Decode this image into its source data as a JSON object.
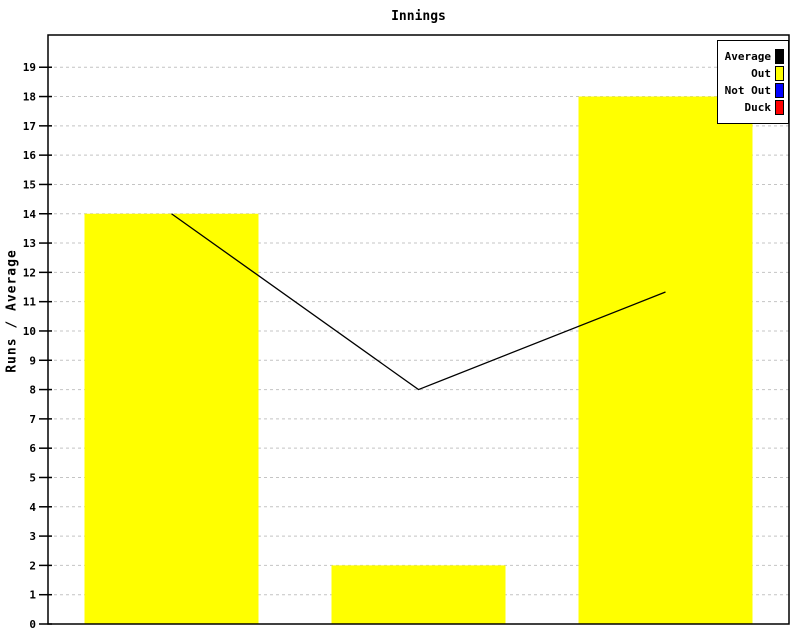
{
  "chart_data": {
    "type": "bar",
    "title": "Innings",
    "ylabel": "Runs / Average",
    "xlabel": "",
    "ylim": [
      0,
      20.1
    ],
    "yticks": [
      0,
      1,
      2,
      3,
      4,
      5,
      6,
      7,
      8,
      9,
      10,
      11,
      12,
      13,
      14,
      15,
      16,
      17,
      18,
      19
    ],
    "xticklabels_visible": false,
    "grid": "horizontal-dashed",
    "grid_color": "#c4c4c4",
    "plot_background": "#ffffff",
    "axis_color": "#000000",
    "legend_position": "top-right",
    "legend": [
      {
        "label": "Average",
        "color": "#000000"
      },
      {
        "label": "Out",
        "color": "#ffff00"
      },
      {
        "label": "Not Out",
        "color": "#0000ff"
      },
      {
        "label": "Duck",
        "color": "#ff0000"
      }
    ],
    "series": [
      {
        "name": "Out",
        "type": "bar",
        "color": "#ffff00",
        "values": [
          14,
          2,
          18
        ]
      },
      {
        "name": "Average",
        "type": "line",
        "color": "#000000",
        "values": [
          14,
          8,
          11.33
        ]
      }
    ]
  }
}
